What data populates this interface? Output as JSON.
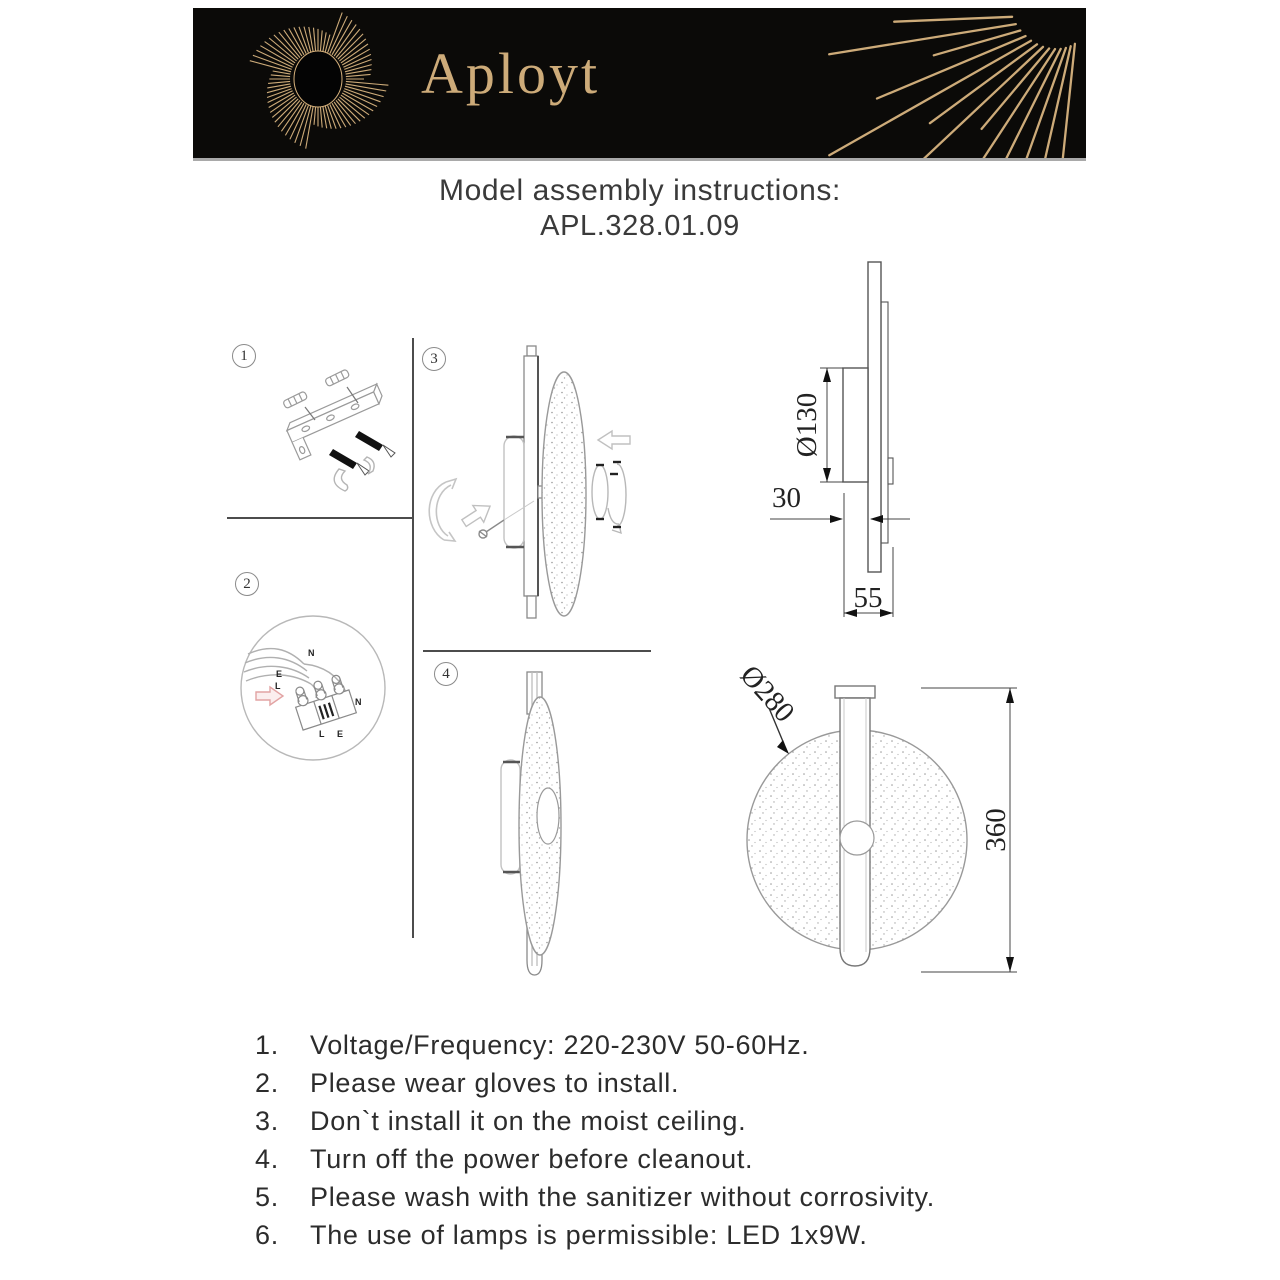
{
  "banner": {
    "brand": "Aployt",
    "bg": "#0b0a08",
    "gold": "#cdab79"
  },
  "header": {
    "title": "Model assembly instructions:",
    "model": "APL.328.01.09"
  },
  "steps": [
    {
      "number": "1"
    },
    {
      "number": "2",
      "labels": {
        "n_top": "N",
        "e_left": "E",
        "l_left": "L",
        "n_right": "N",
        "l_bottom": "L",
        "e_bottom": "E"
      }
    },
    {
      "number": "3"
    },
    {
      "number": "4"
    }
  ],
  "dimensions": {
    "side_view": {
      "diameter": "Ø130",
      "offset": "30",
      "depth": "55"
    },
    "front_view": {
      "diameter": "Ø280",
      "height": "360"
    }
  },
  "instructions": {
    "items": [
      {
        "num": "1.",
        "text": "Voltage/Frequency: 220-230V 50-60Hz."
      },
      {
        "num": "2.",
        "text": "Please wear gloves to install."
      },
      {
        "num": "3.",
        "text": "Don`t install it on the moist ceiling."
      },
      {
        "num": "4.",
        "text": "Turn off the power before cleanout."
      },
      {
        "num": "5.",
        "text": "Please wash with the sanitizer without corrosivity."
      },
      {
        "num": "6.",
        "text": "The use of lamps is permissible: LED 1x9W."
      }
    ]
  }
}
